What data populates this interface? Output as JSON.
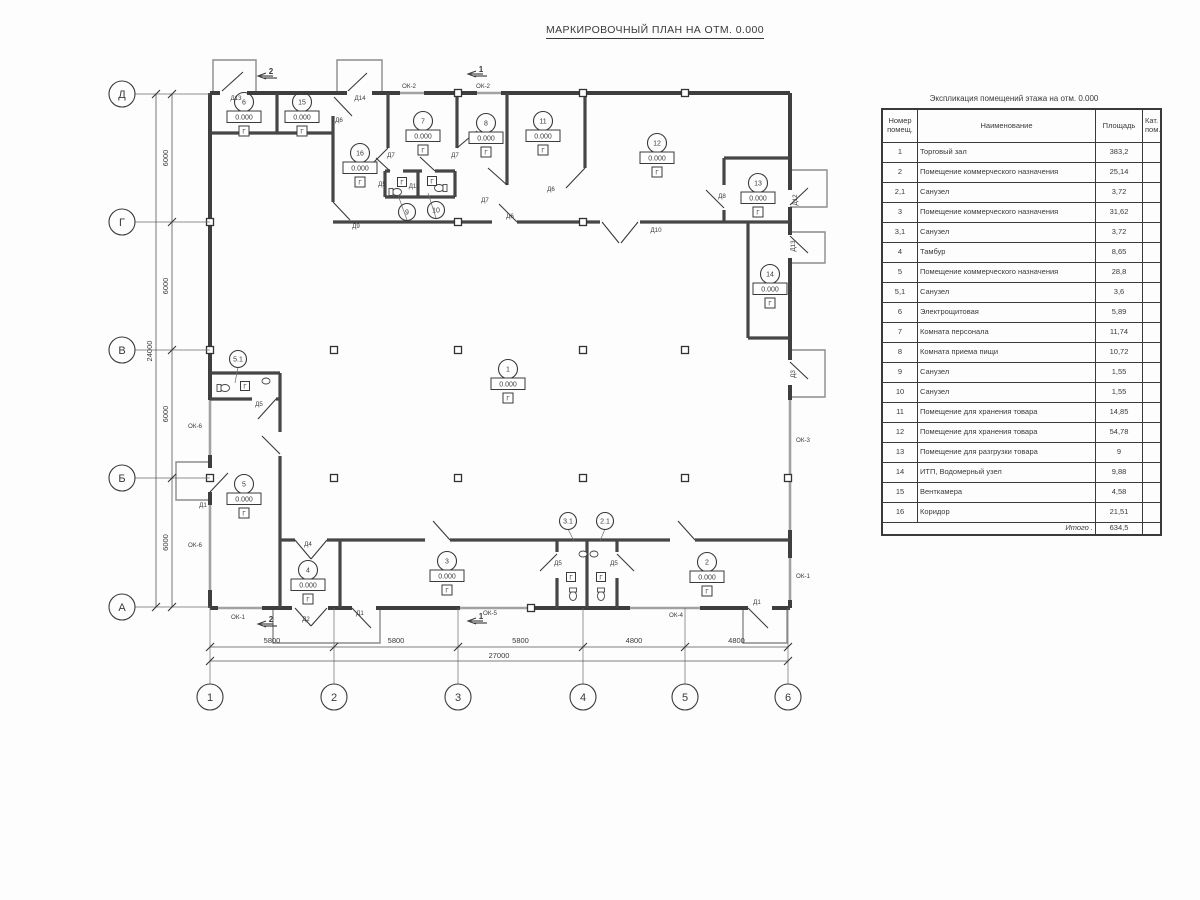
{
  "page": {
    "title": "МАРКИРОВОЧНЫЙ ПЛАН НА ОТМ. 0.000"
  },
  "table": {
    "title": "Экспликация помещений этажа на отм. 0.000",
    "headers": {
      "num": "Номер\nпомещ.",
      "name": "Наименование",
      "area": "Площадь",
      "cat": "Кат.\nпом."
    },
    "rows": [
      {
        "num": "1",
        "name": "Торговый зал",
        "area": "383,2",
        "cat": ""
      },
      {
        "num": "2",
        "name": "Помещение коммерческого назначения",
        "area": "25,14",
        "cat": ""
      },
      {
        "num": "2,1",
        "name": "Санузел",
        "area": "3,72",
        "cat": ""
      },
      {
        "num": "3",
        "name": "Помещение коммерческого назначения",
        "area": "31,62",
        "cat": ""
      },
      {
        "num": "3,1",
        "name": "Санузел",
        "area": "3,72",
        "cat": ""
      },
      {
        "num": "4",
        "name": "Тамбур",
        "area": "8,65",
        "cat": ""
      },
      {
        "num": "5",
        "name": "Помещение коммерческого назначения",
        "area": "28,8",
        "cat": ""
      },
      {
        "num": "5,1",
        "name": "Санузел",
        "area": "3,6",
        "cat": ""
      },
      {
        "num": "6",
        "name": "Электрощитовая",
        "area": "5,89",
        "cat": ""
      },
      {
        "num": "7",
        "name": "Комната персонала",
        "area": "11,74",
        "cat": ""
      },
      {
        "num": "8",
        "name": "Комната приема пищи",
        "area": "10,72",
        "cat": ""
      },
      {
        "num": "9",
        "name": "Санузел",
        "area": "1,55",
        "cat": ""
      },
      {
        "num": "10",
        "name": "Санузел",
        "area": "1,55",
        "cat": ""
      },
      {
        "num": "11",
        "name": "Помещение для хранения товара",
        "area": "14,85",
        "cat": ""
      },
      {
        "num": "12",
        "name": "Помещение для хранения товара",
        "area": "54,78",
        "cat": ""
      },
      {
        "num": "13",
        "name": "Помещение для разгрузки товара",
        "area": "9",
        "cat": ""
      },
      {
        "num": "14",
        "name": "ИТП, Водомерный узел",
        "area": "9,88",
        "cat": ""
      },
      {
        "num": "15",
        "name": "Венткамера",
        "area": "4,58",
        "cat": ""
      },
      {
        "num": "16",
        "name": "Коридор",
        "area": "21,51",
        "cat": ""
      }
    ],
    "total_label": "Итого .",
    "total_value": "634,5"
  },
  "plan": {
    "elevation": "0.000",
    "floor_mark": "Г",
    "axis_cols": [
      {
        "label": "1",
        "x": 210
      },
      {
        "label": "2",
        "x": 334
      },
      {
        "label": "3",
        "x": 458
      },
      {
        "label": "4",
        "x": 583
      },
      {
        "label": "5",
        "x": 685
      },
      {
        "label": "6",
        "x": 788
      }
    ],
    "axis_rows": [
      {
        "label": "Д",
        "y": 94
      },
      {
        "label": "Г",
        "y": 222
      },
      {
        "label": "В",
        "y": 350
      },
      {
        "label": "Б",
        "y": 478
      },
      {
        "label": "А",
        "y": 607
      }
    ],
    "dims_h": [
      {
        "label": "5800",
        "x1": 210,
        "x2": 334
      },
      {
        "label": "5800",
        "x1": 334,
        "x2": 458
      },
      {
        "label": "5800",
        "x1": 458,
        "x2": 583
      },
      {
        "label": "4800",
        "x1": 583,
        "x2": 685
      },
      {
        "label": "4800",
        "x1": 685,
        "x2": 788
      }
    ],
    "dim_h_total": {
      "label": "27000",
      "x1": 210,
      "x2": 788
    },
    "dims_v": [
      {
        "label": "6000",
        "y1": 94,
        "y2": 222
      },
      {
        "label": "6000",
        "y1": 222,
        "y2": 350
      },
      {
        "label": "6000",
        "y1": 350,
        "y2": 478
      },
      {
        "label": "6000",
        "y1": 478,
        "y2": 607
      }
    ],
    "dim_v_total": {
      "label": "24000",
      "y1": 94,
      "y2": 607
    },
    "room_markers": [
      {
        "num": "1",
        "x": 508,
        "y": 369
      },
      {
        "num": "2",
        "x": 707,
        "y": 562
      },
      {
        "num": "3",
        "x": 447,
        "y": 561
      },
      {
        "num": "4",
        "x": 308,
        "y": 570
      },
      {
        "num": "5",
        "x": 244,
        "y": 484
      },
      {
        "num": "6",
        "x": 244,
        "y": 102
      },
      {
        "num": "7",
        "x": 423,
        "y": 121
      },
      {
        "num": "8",
        "x": 486,
        "y": 123
      },
      {
        "num": "11",
        "x": 543,
        "y": 121
      },
      {
        "num": "12",
        "x": 657,
        "y": 143
      },
      {
        "num": "13",
        "x": 758,
        "y": 183
      },
      {
        "num": "14",
        "x": 770,
        "y": 274
      },
      {
        "num": "15",
        "x": 302,
        "y": 102
      },
      {
        "num": "16",
        "x": 360,
        "y": 153
      }
    ],
    "leader_markers": [
      {
        "num": "5.1",
        "x": 238,
        "y": 359,
        "lx": 235,
        "ly": 383
      },
      {
        "num": "9",
        "x": 407,
        "y": 212,
        "lx": 398,
        "ly": 195
      },
      {
        "num": "10",
        "x": 436,
        "y": 210,
        "lx": 428,
        "ly": 193
      },
      {
        "num": "3.1",
        "x": 568,
        "y": 521,
        "lx": 574,
        "ly": 541
      },
      {
        "num": "2.1",
        "x": 605,
        "y": 521,
        "lx": 600,
        "ly": 541
      }
    ],
    "mark_boxes": [
      {
        "x": 245,
        "y": 386
      },
      {
        "x": 402,
        "y": 182
      },
      {
        "x": 432,
        "y": 181
      },
      {
        "x": 571,
        "y": 577
      },
      {
        "x": 601,
        "y": 577
      }
    ],
    "door_labels": [
      {
        "text": "Д13",
        "x": 236,
        "y": 100
      },
      {
        "text": "Д14",
        "x": 360,
        "y": 100
      },
      {
        "text": "Д6",
        "x": 339,
        "y": 122
      },
      {
        "text": "Д9",
        "x": 356,
        "y": 228
      },
      {
        "text": "Д7",
        "x": 391,
        "y": 157
      },
      {
        "text": "Д7",
        "x": 455,
        "y": 157
      },
      {
        "text": "Д7",
        "x": 485,
        "y": 202
      },
      {
        "text": "Д6",
        "x": 551,
        "y": 191
      },
      {
        "text": "Д6",
        "x": 510,
        "y": 218
      },
      {
        "text": "Д5",
        "x": 382,
        "y": 186
      },
      {
        "text": "Д11",
        "x": 414,
        "y": 188
      },
      {
        "text": "Д8",
        "x": 722,
        "y": 198
      },
      {
        "text": "Д10",
        "x": 656,
        "y": 232
      },
      {
        "text": "Д12",
        "x": 797,
        "y": 200,
        "rot": 1
      },
      {
        "text": "Д13",
        "x": 795,
        "y": 246,
        "rot": 1
      },
      {
        "text": "Д3",
        "x": 795,
        "y": 374,
        "rot": 1
      },
      {
        "text": "Д5",
        "x": 259,
        "y": 406
      },
      {
        "text": "Д1",
        "x": 203,
        "y": 507
      },
      {
        "text": "Д4",
        "x": 308,
        "y": 546
      },
      {
        "text": "Д2",
        "x": 306,
        "y": 621
      },
      {
        "text": "Д1",
        "x": 360,
        "y": 615
      },
      {
        "text": "Д5",
        "x": 558,
        "y": 565
      },
      {
        "text": "Д5",
        "x": 614,
        "y": 565
      },
      {
        "text": "Д1",
        "x": 757,
        "y": 604
      }
    ],
    "window_labels": [
      {
        "text": "ОК-2",
        "x": 409,
        "y": 88
      },
      {
        "text": "ОК-2",
        "x": 483,
        "y": 88
      },
      {
        "text": "ОК-6",
        "x": 195,
        "y": 428
      },
      {
        "text": "ОК-6",
        "x": 195,
        "y": 547
      },
      {
        "text": "ОК-1",
        "x": 238,
        "y": 619
      },
      {
        "text": "ОК-5",
        "x": 490,
        "y": 615
      },
      {
        "text": "ОК-4",
        "x": 676,
        "y": 617
      },
      {
        "text": "ОК-3",
        "x": 803,
        "y": 442
      },
      {
        "text": "ОК-1",
        "x": 803,
        "y": 578
      }
    ],
    "section_markers": [
      {
        "num": "2",
        "x": 258,
        "y": 76
      },
      {
        "num": "1",
        "x": 468,
        "y": 74
      },
      {
        "num": "2",
        "x": 258,
        "y": 624
      },
      {
        "num": "1",
        "x": 468,
        "y": 621
      }
    ]
  }
}
